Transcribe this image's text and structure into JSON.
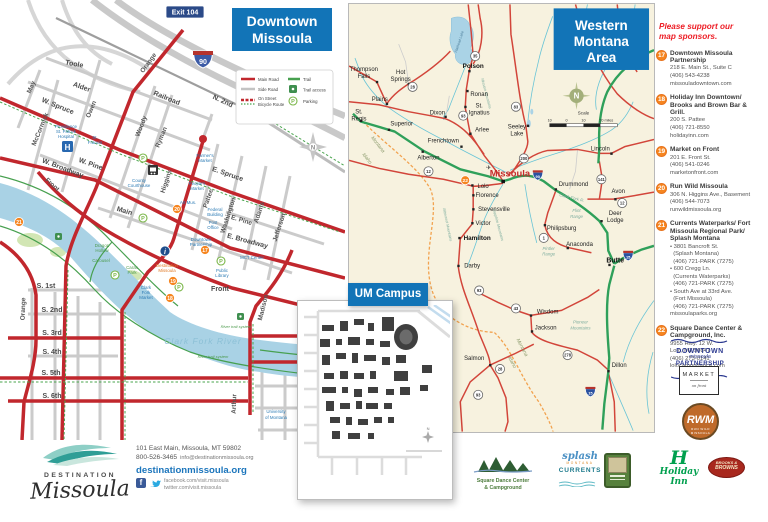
{
  "downtown": {
    "title": [
      "Downtown",
      "Missoula"
    ],
    "exit_badge": "Exit 104",
    "interstate_label": "90",
    "compass": "N",
    "legend": {
      "main_road": "Main Road",
      "side_road": "Side Road",
      "bike_1": "On Street",
      "bike_2": "Bicycle Route",
      "trail": "Trail",
      "trail_access": "Trail access",
      "parking": "Parking"
    },
    "icons": {
      "parking_letter": "P",
      "hospital_letter": "H",
      "info_letter": "i"
    },
    "streets": {
      "toole": "Toole",
      "alder": "Alder",
      "w_spruce": "W. Spruce",
      "e_spruce": "E. Spruce",
      "may": "May",
      "mccormick": "McCormick",
      "owen": "Owen",
      "orange_n": "Orange",
      "orange_s": "Orange",
      "woody": "Woody",
      "ryman": "Ryman",
      "higgins": "Higgins",
      "railroad": "Railroad",
      "n_2nd": "N. 2nd",
      "w_pine": "W. Pine",
      "e_pine": "E. Pine",
      "w_broadway": "W. Broadway",
      "e_broadway": "E. Broadway",
      "front_w": "Front",
      "front_e": "Front",
      "main": "Main",
      "pattee": "Pattee",
      "washington": "Washington",
      "adams": "Adams",
      "jefferson": "Jefferson",
      "madison": "Madison",
      "arthur": "Arthur",
      "s_1st": "S. 1st",
      "s_2nd": "S. 2nd",
      "s_3rd": "S. 3rd",
      "s_4th": "S. 4th",
      "s_5th": "S. 5th",
      "s_6th": "S. 6th"
    },
    "pois": {
      "hospital": [
        "Providence",
        "St. Patrick",
        "Hospital"
      ],
      "st_francis": [
        "St.",
        "Francis"
      ],
      "courthouse": [
        "County",
        "Courthouse"
      ],
      "farmers_market": [
        "Farmer's",
        "Market"
      ],
      "peoples_market": [
        "People's",
        "Market"
      ],
      "art_museum": "Art Mus.",
      "federal_building": [
        "Federal",
        "Building"
      ],
      "post_office": [
        "Post",
        "Office"
      ],
      "downtown_partnership": [
        "Downtown",
        "Partnership"
      ],
      "mct_center": "MCT Center",
      "public_library": [
        "Public",
        "Library"
      ],
      "dragon_hollow": [
        "Dragon",
        "Hollow"
      ],
      "carousel": "Carousel",
      "caras_park": [
        "Caras",
        "Park"
      ],
      "clark_fork_market": [
        "Clark",
        "Fork",
        "Market"
      ],
      "destination_missoula": [
        "Destination",
        "Missoula"
      ],
      "university": [
        "University",
        "of Montana"
      ],
      "river": "Clark Fork River",
      "river_trail_1": "River trail system",
      "river_trail_2": "River trail system"
    },
    "markers": {
      "m17": "17",
      "m18": "18",
      "m19": "19",
      "m20": "20",
      "m21": "21"
    }
  },
  "western": {
    "title": [
      "Western",
      "Montana",
      "Area"
    ],
    "compass": "N",
    "scale": {
      "label": "Scale",
      "ticks": [
        "10",
        "0",
        "10",
        "20 miles"
      ]
    },
    "city": "Missoula",
    "marker22": "22",
    "airport_icon": "✈",
    "towns": {
      "thompson_falls": [
        "Thompson",
        "Falls"
      ],
      "hot_springs": [
        "Hot",
        "Springs"
      ],
      "plains": "Plains",
      "st_regis": [
        "St.",
        "Regis"
      ],
      "superior": "Superior",
      "dixon": "Dixon",
      "polson": "Polson",
      "ronan": "Ronan",
      "st_ignatius": [
        "St.",
        "Ignatius"
      ],
      "arlee": "Arlee",
      "seeley_lake": [
        "Seeley",
        "Lake"
      ],
      "frenchtown": "Frenchtown",
      "alberton": "Alberton",
      "lincoln": "Lincoln",
      "lolo": "Lolo",
      "florence": "Florence",
      "stevensville": "Stevensville",
      "victor": "Victor",
      "hamilton": "Hamilton",
      "darby": "Darby",
      "philipsburg": "Philipsburg",
      "anaconda": "Anaconda",
      "drummond": "Drummond",
      "avon": "Avon",
      "deer_lodge": [
        "Deer",
        "Lodge"
      ],
      "butte": "Butte",
      "wisdom": "Wisdom",
      "jackson": "Jackson",
      "salmon": "Salmon",
      "dillon": "Dillon"
    },
    "geo": {
      "montana_w": "Montana",
      "idaho_w": "Idaho",
      "montana_s": "Montana",
      "idaho_s": "Idaho",
      "flathead": "Flathead Lake",
      "clark_fork": "Clark Fork R.",
      "flint": [
        "Flint",
        "Range"
      ],
      "pintler": [
        "Pintler",
        "Range"
      ],
      "pioneer": [
        "Pioneer",
        "Mountains"
      ],
      "bitterroot": "Bitterroot Mountains",
      "sapphire": "Sapphire Mountains",
      "mission": "Mission Mountains"
    },
    "shields": {
      "s35": "35",
      "s93n": "93",
      "s83": "83",
      "s200": "200",
      "s28": "28",
      "s12w": "12",
      "s90": "90",
      "s1": "1",
      "s43": "43",
      "s93c": "93",
      "s141": "141",
      "s12e": "12",
      "s15n": "15",
      "s15s": "15",
      "s278": "278",
      "s28s": "28",
      "s93s": "93"
    }
  },
  "campus": {
    "title": "UM Campus",
    "compass": "N"
  },
  "sponsors": {
    "heading": "Please support our map sponsors.",
    "items": [
      {
        "num": "17",
        "name": "Downtown Missoula Partnership",
        "lines": [
          "218 E. Main St., Suite C",
          "(406) 543-4238",
          "missouladowntown.com"
        ]
      },
      {
        "num": "18",
        "name": "Holiday Inn Downtown/ Brooks and Brown Bar & Grill.",
        "lines": [
          "200 S. Pattee",
          "(406) 721-8550",
          "holidayinn.com"
        ]
      },
      {
        "num": "19",
        "name": "Market on Front",
        "lines": [
          "201 E. Front St.",
          "(406) 541-0246",
          "marketonfront.com"
        ]
      },
      {
        "num": "20",
        "name": "Run Wild Missoula",
        "lines": [
          "306 N. Higgins Ave., Basement",
          "(406) 544-7073",
          "runwildmissoula.org"
        ]
      },
      {
        "num": "21",
        "name": "Currents Waterparks/ Fort Missoula Regional Park/ Splash Montana",
        "lines": [
          "• 3801 Bancroft St.",
          "  (Splash Montana)",
          "  (406) 721-PARK (7275)",
          "• 600 Cregg Ln.",
          "  (Currents Waterparks)",
          "  (406) 721-PARK (7275)",
          "• South Ave at 33rd Ave.",
          "  (Fort Missoula)",
          "  (406) 721-PARK (7275)",
          "missoulaparks.org"
        ]
      },
      {
        "num": "22",
        "name": "Square Dance Center & Campground, Inc.",
        "lines": [
          "9955 Hwy. 12 W.",
          "Lolo, MT 59847",
          "(406) 273-0141",
          "lolocampndance.com"
        ]
      }
    ]
  },
  "logos": {
    "dmp": [
      "DOWNTOWN",
      "missoula",
      "PARTNERSHIP"
    ],
    "market": [
      "MARKET",
      "on front"
    ],
    "rwm": {
      "abbr": "RWM",
      "name": "RUN WILD MISSOULA"
    },
    "holiday_h": "H",
    "holiday": "Holiday Inn",
    "brooks": [
      "BROOKS &",
      "BROWNS"
    ],
    "square_dance": [
      "Square Dance Center",
      "& Campground"
    ],
    "splash": [
      "splash",
      "MONTANA"
    ],
    "currents": "CURRENTS"
  },
  "footer": {
    "brand_top": "DESTINATION",
    "brand_script": "Missoula",
    "address": "101 East Main, Missoula, MT 59802",
    "phone": "800-526-3465",
    "email": "info@destinationmissoula.org",
    "website": "destinationmissoula.org",
    "fb_letter": "f",
    "facebook": "facebook.com/visit.missoula",
    "twitter": "twitter.com/visit.missoula"
  }
}
